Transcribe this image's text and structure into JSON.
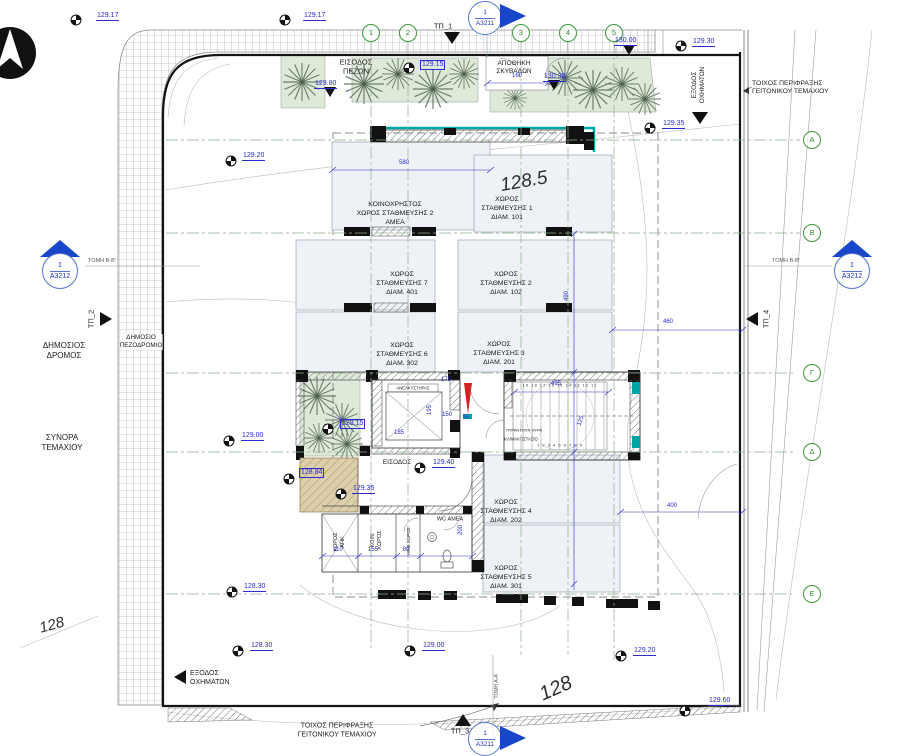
{
  "drawing": {
    "grid": {
      "columns": [
        {
          "label": "1",
          "x": 371
        },
        {
          "label": "2",
          "x": 408
        },
        {
          "label": "3",
          "x": 521
        },
        {
          "label": "4",
          "x": 568
        },
        {
          "label": "5",
          "x": 614
        }
      ],
      "rows": [
        {
          "label": "Α",
          "y": 140
        },
        {
          "label": "Β",
          "y": 233
        },
        {
          "label": "Γ",
          "y": 373
        },
        {
          "label": "Δ",
          "y": 452
        },
        {
          "label": "Ε",
          "y": 594
        }
      ]
    },
    "sections": {
      "left": {
        "num": "1",
        "code": "Α3212",
        "section_label": "ΤΟΜΗ Β-Β'"
      },
      "right": {
        "num": "1",
        "code": "Α3212",
        "section_label": "ΤΟΜΗ Β-Β'"
      },
      "top": {
        "num": "1",
        "code": "Α3211"
      },
      "bottom": {
        "num": "1",
        "code": "Α3211",
        "section_label": "ΤΟΜΗ Α-Α'"
      }
    },
    "tp_markers": {
      "tp1": "ΤΠ_1",
      "tp2": "ΤΠ_2",
      "tp3": "ΤΠ_3",
      "tp4": "ΤΠ_4"
    },
    "labels": {
      "pedestrian_entrance": "ΕΙΣΟΔΟΣ\nΠΕΖΩΝ",
      "bin_store": "ΑΠΟΘΗΚΗ\nΣΚΥΒΑΛΩΝ",
      "fence_wall_top": "ΤΟΙΧΟΣ ΠΕΡΙΦΡΑΞΗΣ\nΓΕΙΤΟΝΙΚΟΥ ΤΕΜΑΧΙΟΥ",
      "fence_wall_bottom": "ΤΟΙΧΟΣ ΠΕΡΙΦΡΑΞΗΣ\nΓΕΙΤΟΝΙΚΟΥ ΤΕΜΑΧΙΟΥ",
      "vehicle_exit_top": "ΕΞΟΔΟΣ\nΟΧΗΜΑΤΩΝ",
      "vehicle_exit_bottom": "ΕΞΟΔΟΣ\nΟΧΗΜΑΤΩΝ",
      "public_road": "ΔΗΜΟΣΙΟΣ\nΔΡΟΜΟΣ",
      "public_sidewalk": "ΔΗΜΟΣΙΟ\nΠΕΖΟΔΡΟΜΙΟ",
      "plot_border": "ΣΥΝΟΡΑ\nΤΕΜΑΧΙΟΥ",
      "entrance": "ΕΙΣΟΔΟΣ",
      "contour_left": "128",
      "contour_bottom": "128",
      "level_note": "128.5"
    },
    "rooms": {
      "elevator": "ΑΝΕΛΚΥΣΤΗΡΑΣ",
      "staircase": "ΚΛΙΜΑΚΟΣΤΑΣΙΟ",
      "fire_door": "ΠΥΡΑΝΤΟΧΗ ΘΥΡΑ",
      "wc": "WC ΑΜΕΑ",
      "utility_ahk": "ΧΩΡΟΣ\nΑΗΚ",
      "common_room": "ΚΟΙΝ.\nΧΩΡΟΣ",
      "mech_room": "ΗΛΜ ΧΩΡΟΣ",
      "steps_low": "1 2 3 4 5 6 7 8 9",
      "steps_high": "19 18 17 16 15 14 13 12 11"
    },
    "parking": [
      {
        "name": "ΚΟΙΝΟΧΡΗΣΤΟΣ\nΧΩΡΟΣ ΣΤΑΘΜΕΥΣΗΣ 2\nΑΜΕΑ",
        "x": 395,
        "y": 214
      },
      {
        "name": "ΧΩΡΟΣ\nΣΤΑΘΜΕΥΣΗΣ 1\nΔΙΑΜ. 101",
        "x": 507,
        "y": 209
      },
      {
        "name": "ΧΩΡΟΣ\nΣΤΑΘΜΕΥΣΗΣ 7\nΔΙΑΜ. 401",
        "x": 402,
        "y": 284
      },
      {
        "name": "ΧΩΡΟΣ\nΣΤΑΘΜΕΥΣΗΣ 2\nΔΙΑΜ. 102",
        "x": 506,
        "y": 284
      },
      {
        "name": "ΧΩΡΟΣ\nΣΤΑΘΜΕΥΣΗΣ 6\nΔΙΑΜ. 302",
        "x": 402,
        "y": 355
      },
      {
        "name": "ΧΩΡΟΣ\nΣΤΑΘΜΕΥΣΗΣ 3\nΔΙΑΜ. 201",
        "x": 499,
        "y": 354
      },
      {
        "name": "ΧΩΡΟΣ\nΣΤΑΘΜΕΥΣΗΣ 4\nΔΙΑΜ. 202",
        "x": 506,
        "y": 512
      },
      {
        "name": "ΧΩΡΟΣ\nΣΤΑΘΜΕΥΣΗΣ 5\nΔΙΑΜ. 301",
        "x": 506,
        "y": 578
      }
    ],
    "elevations": [
      {
        "v": "129.17",
        "x": 96,
        "y": 12,
        "m": "q",
        "mx": 76,
        "my": 20
      },
      {
        "v": "129.17",
        "x": 303,
        "y": 12,
        "m": "q",
        "mx": 285,
        "my": 20
      },
      {
        "v": "129.80",
        "x": 314,
        "y": 80,
        "m": "t",
        "mx": 330,
        "my": 92
      },
      {
        "v": "129.15",
        "x": 420,
        "y": 60,
        "m": "q",
        "mx": 409,
        "my": 68,
        "box": true
      },
      {
        "v": "130.00",
        "x": 614,
        "y": 37,
        "m": "t",
        "mx": 629,
        "my": 50
      },
      {
        "v": "130.30",
        "x": 543,
        "y": 73,
        "m": "t",
        "mx": 554,
        "my": 85
      },
      {
        "v": "129.30",
        "x": 692,
        "y": 38,
        "m": "q",
        "mx": 681,
        "my": 46
      },
      {
        "v": "129.35",
        "x": 662,
        "y": 120,
        "m": "q",
        "mx": 650,
        "my": 128
      },
      {
        "v": "129.20",
        "x": 242,
        "y": 152,
        "m": "q",
        "mx": 231,
        "my": 161
      },
      {
        "v": "129.15",
        "x": 340,
        "y": 419,
        "m": "q",
        "mx": 328,
        "my": 429,
        "box": true
      },
      {
        "v": "129.00",
        "x": 241,
        "y": 432,
        "m": "q",
        "mx": 229,
        "my": 441
      },
      {
        "v": "128.84",
        "x": 299,
        "y": 468,
        "m": "q",
        "mx": 289,
        "my": 479,
        "box": true
      },
      {
        "v": "129.35",
        "x": 352,
        "y": 485,
        "m": "q",
        "mx": 341,
        "my": 494
      },
      {
        "v": "129.40",
        "x": 432,
        "y": 459,
        "m": "q",
        "mx": 420,
        "my": 468
      },
      {
        "v": "128.30",
        "x": 243,
        "y": 583,
        "m": "q",
        "mx": 232,
        "my": 592
      },
      {
        "v": "128.30",
        "x": 250,
        "y": 642,
        "m": "q",
        "mx": 238,
        "my": 651
      },
      {
        "v": "129.00",
        "x": 422,
        "y": 642,
        "m": "q",
        "mx": 410,
        "my": 651
      },
      {
        "v": "129.20",
        "x": 633,
        "y": 647,
        "m": "q",
        "mx": 621,
        "my": 656
      },
      {
        "v": "129.60",
        "x": 708,
        "y": 697,
        "m": "q",
        "mx": 685,
        "my": 711
      }
    ],
    "dimensions": [
      {
        "v": "580",
        "x": 404,
        "y": 163
      },
      {
        "v": "160",
        "x": 517,
        "y": 76
      },
      {
        "v": "460",
        "x": 668,
        "y": 322
      },
      {
        "v": "490",
        "x": 567,
        "y": 296,
        "rot": -90
      },
      {
        "v": "400",
        "x": 672,
        "y": 506
      },
      {
        "v": "495",
        "x": 556,
        "y": 384
      },
      {
        "v": "175",
        "x": 446,
        "y": 380
      },
      {
        "v": "150",
        "x": 447,
        "y": 415
      },
      {
        "v": "35",
        "x": 466,
        "y": 418
      },
      {
        "v": "195",
        "x": 430,
        "y": 410,
        "rot": -90
      },
      {
        "v": "185",
        "x": 399,
        "y": 433
      },
      {
        "v": "125",
        "x": 581,
        "y": 421,
        "rot": -70
      },
      {
        "v": "110",
        "x": 338,
        "y": 550
      },
      {
        "v": "155",
        "x": 373,
        "y": 550
      },
      {
        "v": "80",
        "x": 406,
        "y": 550
      },
      {
        "v": "200",
        "x": 461,
        "y": 530,
        "rot": -90
      }
    ],
    "colors": {
      "teal": "#00a6a6",
      "dimension_blue": "#2b2bd0",
      "grid_green": "#3a9a3a",
      "door_red": "#d42222",
      "planting": "#dfe9da",
      "parking_fill": "#eef1f6",
      "ramp_sand": "#decfac"
    }
  }
}
